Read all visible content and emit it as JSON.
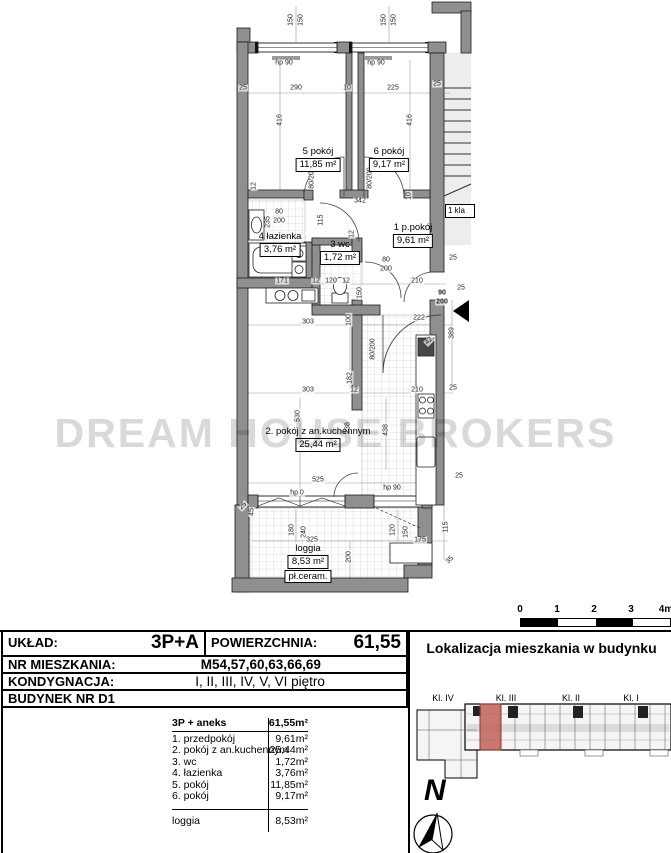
{
  "watermark": "DREAM HOUSE BROKERS",
  "plan": {
    "staircase_label": "1 kla",
    "rooms": [
      {
        "name": "5 pokój",
        "area": "11,85 m²",
        "x": 318,
        "y": 146
      },
      {
        "name": "6 pokój",
        "area": "9,17 m²",
        "x": 389,
        "y": 146
      },
      {
        "name": "4 łazienka",
        "area": "3,76 m²",
        "x": 280,
        "y": 231
      },
      {
        "name": "3 wc",
        "area": "1,72 m²",
        "x": 340,
        "y": 239
      },
      {
        "name": "1 p.pokój",
        "area": "9,61 m²",
        "x": 413,
        "y": 222
      },
      {
        "name": "2. pokój z an.kuchennym",
        "area": "25,44 m²",
        "x": 318,
        "y": 426
      },
      {
        "name": "loggia",
        "area": "8,53 m²",
        "extra": "pł.ceram.",
        "x": 308,
        "y": 543
      }
    ],
    "dims": [
      {
        "t": "150",
        "x": 291,
        "y": 20,
        "r": 90
      },
      {
        "t": "150",
        "x": 301,
        "y": 20,
        "r": 90
      },
      {
        "t": "150",
        "x": 384,
        "y": 20,
        "r": 90
      },
      {
        "t": "150",
        "x": 394,
        "y": 20,
        "r": 90
      },
      {
        "t": "hp 90",
        "x": 284,
        "y": 63
      },
      {
        "t": "hp 90",
        "x": 376,
        "y": 63
      },
      {
        "t": "25",
        "x": 243,
        "y": 88
      },
      {
        "t": "290",
        "x": 296,
        "y": 88
      },
      {
        "t": "10",
        "x": 347,
        "y": 88
      },
      {
        "t": "225",
        "x": 393,
        "y": 88
      },
      {
        "t": "25",
        "x": 437,
        "y": 84
      },
      {
        "t": "416",
        "x": 280,
        "y": 120,
        "r": 90
      },
      {
        "t": "416",
        "x": 410,
        "y": 120,
        "r": 90
      },
      {
        "t": "12",
        "x": 254,
        "y": 186,
        "r": 90
      },
      {
        "t": "80/200",
        "x": 312,
        "y": 178,
        "r": 90
      },
      {
        "t": "80/200",
        "x": 370,
        "y": 178,
        "r": 90
      },
      {
        "t": "342",
        "x": 360,
        "y": 201
      },
      {
        "t": "10",
        "x": 409,
        "y": 196,
        "r": 90
      },
      {
        "t": "80",
        "x": 279,
        "y": 212
      },
      {
        "t": "200",
        "x": 279,
        "y": 221
      },
      {
        "t": "235",
        "x": 268,
        "y": 222,
        "r": 90
      },
      {
        "t": "115",
        "x": 321,
        "y": 220,
        "r": 90
      },
      {
        "t": "12",
        "x": 352,
        "y": 234,
        "r": 90
      },
      {
        "t": "80",
        "x": 386,
        "y": 260
      },
      {
        "t": "200",
        "x": 386,
        "y": 269
      },
      {
        "t": "25",
        "x": 453,
        "y": 258
      },
      {
        "t": "171",
        "x": 282,
        "y": 281
      },
      {
        "t": "12",
        "x": 316,
        "y": 281
      },
      {
        "t": "120",
        "x": 331,
        "y": 281
      },
      {
        "t": "12",
        "x": 346,
        "y": 281
      },
      {
        "t": "150",
        "x": 360,
        "y": 293,
        "r": 90
      },
      {
        "t": "210",
        "x": 417,
        "y": 281
      },
      {
        "t": "90",
        "x": 442,
        "y": 293,
        "b": 1
      },
      {
        "t": "200",
        "x": 442,
        "y": 302,
        "b": 1
      },
      {
        "t": "25",
        "x": 461,
        "y": 288
      },
      {
        "t": "389",
        "x": 452,
        "y": 333,
        "r": 90
      },
      {
        "t": "303",
        "x": 308,
        "y": 322
      },
      {
        "t": "100",
        "x": 349,
        "y": 320,
        "r": 90
      },
      {
        "t": "222",
        "x": 419,
        "y": 318
      },
      {
        "t": "42",
        "x": 429,
        "y": 341,
        "r": 45
      },
      {
        "t": "80/200",
        "x": 373,
        "y": 349,
        "r": 90
      },
      {
        "t": "182",
        "x": 350,
        "y": 378,
        "r": 90
      },
      {
        "t": "303",
        "x": 308,
        "y": 390
      },
      {
        "t": "12",
        "x": 354,
        "y": 390
      },
      {
        "t": "210",
        "x": 417,
        "y": 390
      },
      {
        "t": "25",
        "x": 453,
        "y": 388
      },
      {
        "t": "530",
        "x": 298,
        "y": 416,
        "r": 90
      },
      {
        "t": "238",
        "x": 348,
        "y": 428,
        "r": 90
      },
      {
        "t": "438",
        "x": 386,
        "y": 430,
        "r": 90
      },
      {
        "t": "525",
        "x": 318,
        "y": 480
      },
      {
        "t": "hp 0",
        "x": 297,
        "y": 493
      },
      {
        "t": "hp 90",
        "x": 392,
        "y": 488
      },
      {
        "t": "25",
        "x": 459,
        "y": 476
      },
      {
        "t": "25",
        "x": 243,
        "y": 506,
        "r": 45
      },
      {
        "t": "45",
        "x": 252,
        "y": 512,
        "r": 90
      },
      {
        "t": "180",
        "x": 292,
        "y": 530,
        "r": 90
      },
      {
        "t": "240",
        "x": 304,
        "y": 532,
        "r": 90
      },
      {
        "t": "120",
        "x": 393,
        "y": 530,
        "r": 90
      },
      {
        "t": "150",
        "x": 406,
        "y": 532,
        "r": 90
      },
      {
        "t": "325",
        "x": 312,
        "y": 540
      },
      {
        "t": "175",
        "x": 420,
        "y": 540
      },
      {
        "t": "200",
        "x": 349,
        "y": 557,
        "r": 90
      },
      {
        "t": "115",
        "x": 446,
        "y": 527,
        "r": 90
      },
      {
        "t": "35",
        "x": 450,
        "y": 560,
        "r": 45
      }
    ]
  },
  "scalebar": {
    "labels": [
      "0",
      "1",
      "2",
      "3",
      "4m"
    ]
  },
  "info_table": {
    "uklad_label": "UKŁAD:",
    "uklad_value": "3P+A",
    "pow_label": "POWIERZCHNIA:",
    "pow_value": "61,55",
    "nr_label": "NR MIESZKANIA:",
    "nr_value": "M54,57,60,63,66,69",
    "kond_label": "KONDYGNACJA:",
    "kond_value": "I, II, III, IV, V, VI piętro",
    "budynek_label": "BUDYNEK NR D1"
  },
  "room_list": {
    "header": {
      "name": "3P + aneks",
      "area": "61,55m²"
    },
    "items": [
      {
        "name": "1. przedpokój",
        "area": "9,61m²"
      },
      {
        "name": "2. pokój z an.kuchennym",
        "area": "25,44m²"
      },
      {
        "name": "3. wc",
        "area": "1,72m²"
      },
      {
        "name": "4. łazienka",
        "area": "3,76m²"
      },
      {
        "name": "5. pokój",
        "area": "11,85m²"
      },
      {
        "name": "6. pokój",
        "area": "9,17m²"
      }
    ],
    "footer": {
      "name": "loggia",
      "area": "8,53m²"
    }
  },
  "location": {
    "title": "Lokalizacja mieszkania w budynku",
    "stairwells": [
      "Kl. IV",
      "Kl. III",
      "Kl. II",
      "Kl. I"
    ],
    "north_label": "N"
  }
}
